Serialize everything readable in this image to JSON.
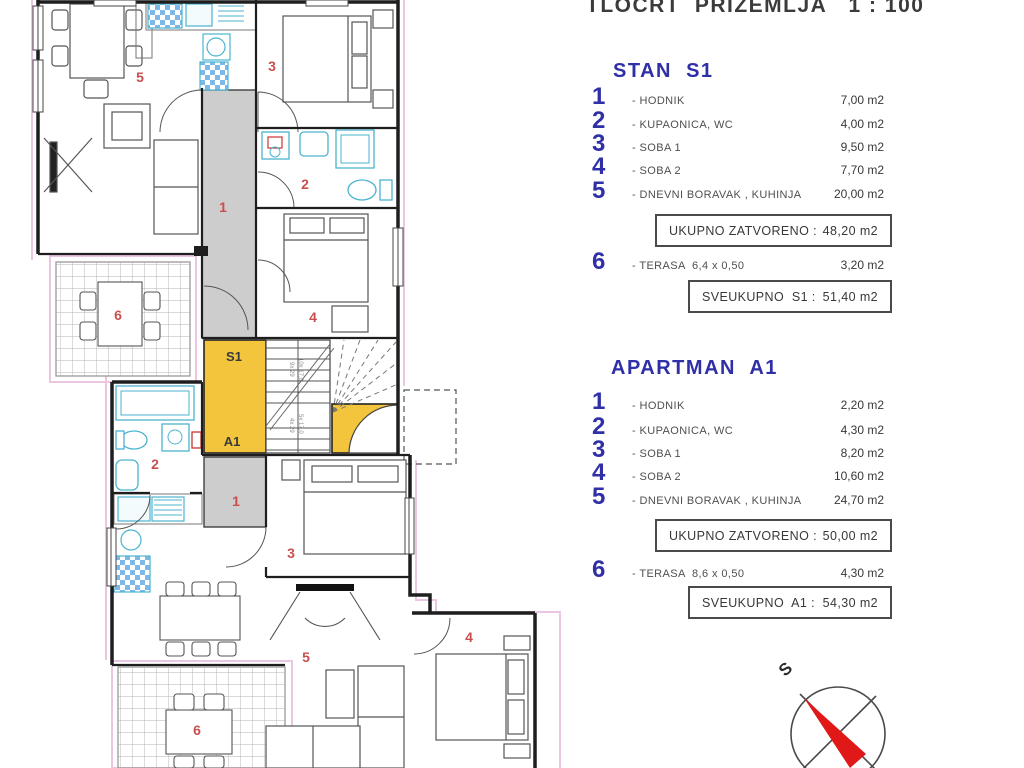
{
  "title": "TLOCRT  PRIZEMLJA   1 : 100",
  "colors": {
    "accent_blue": "#2f2fa8",
    "room_number_red": "#c94f4f",
    "landing_yellow": "#f2c53d",
    "corridor_gray": "#cdcdcd",
    "fixture_cyan": "#4ab4cf",
    "outline_pink": "#eac6e2",
    "wall_black": "#1e1e1e",
    "compass_red": "#e01818"
  },
  "legend": {
    "s1": {
      "heading": "STAN  S1",
      "rows": [
        {
          "num": "1",
          "label": "- HODNIK",
          "value": "7,00 m2"
        },
        {
          "num": "2",
          "label": "- KUPAONICA, WC",
          "value": "4,00 m2"
        },
        {
          "num": "3",
          "label": "- SOBA 1",
          "value": "9,50 m2"
        },
        {
          "num": "4",
          "label": "- SOBA 2",
          "value": "7,70 m2"
        },
        {
          "num": "5",
          "label": "- DNEVNI BORAVAK , KUHINJA",
          "value": "20,00 m2"
        }
      ],
      "closed_label": "UKUPNO ZATVORENO :",
      "closed_value": "48,20 m2",
      "terrace": {
        "num": "6",
        "label": "- TERASA  6,4 x 0,50",
        "value": "3,20 m2"
      },
      "total_label": "SVEUKUPNO  S1 :",
      "total_value": "51,40 m2"
    },
    "a1": {
      "heading": "APARTMAN  A1",
      "rows": [
        {
          "num": "1",
          "label": "- HODNIK",
          "value": "2,20 m2"
        },
        {
          "num": "2",
          "label": "- KUPAONICA, WC",
          "value": "4,30 m2"
        },
        {
          "num": "3",
          "label": "- SOBA 1",
          "value": "8,20 m2"
        },
        {
          "num": "4",
          "label": "- SOBA 2",
          "value": "10,60 m2"
        },
        {
          "num": "5",
          "label": "- DNEVNI BORAVAK , KUHINJA",
          "value": "24,70 m2"
        }
      ],
      "closed_label": "UKUPNO ZATVORENO :",
      "closed_value": "50,00 m2",
      "terrace": {
        "num": "6",
        "label": "- TERASA  8,6 x 0,50",
        "value": "4,30 m2"
      },
      "total_label": "SVEUKUPNO  A1 :",
      "total_value": "54,30 m2"
    }
  },
  "plan": {
    "landing_upper": "S1",
    "landing_lower": "A1",
    "stair_note_upper_a": "9x 29",
    "stair_note_upper_b": "10x 17,0",
    "stair_note_lower_a": "4x 29",
    "stair_note_lower_b": "5x 17,0",
    "s1_rooms": {
      "r1": "1",
      "r2": "2",
      "r3": "3",
      "r4": "4",
      "r5": "5",
      "r6": "6"
    },
    "a1_rooms": {
      "r1": "1",
      "r2": "2",
      "r3": "3",
      "r4": "4",
      "r5": "5",
      "r6": "6"
    }
  },
  "compass": {
    "label": "S"
  }
}
